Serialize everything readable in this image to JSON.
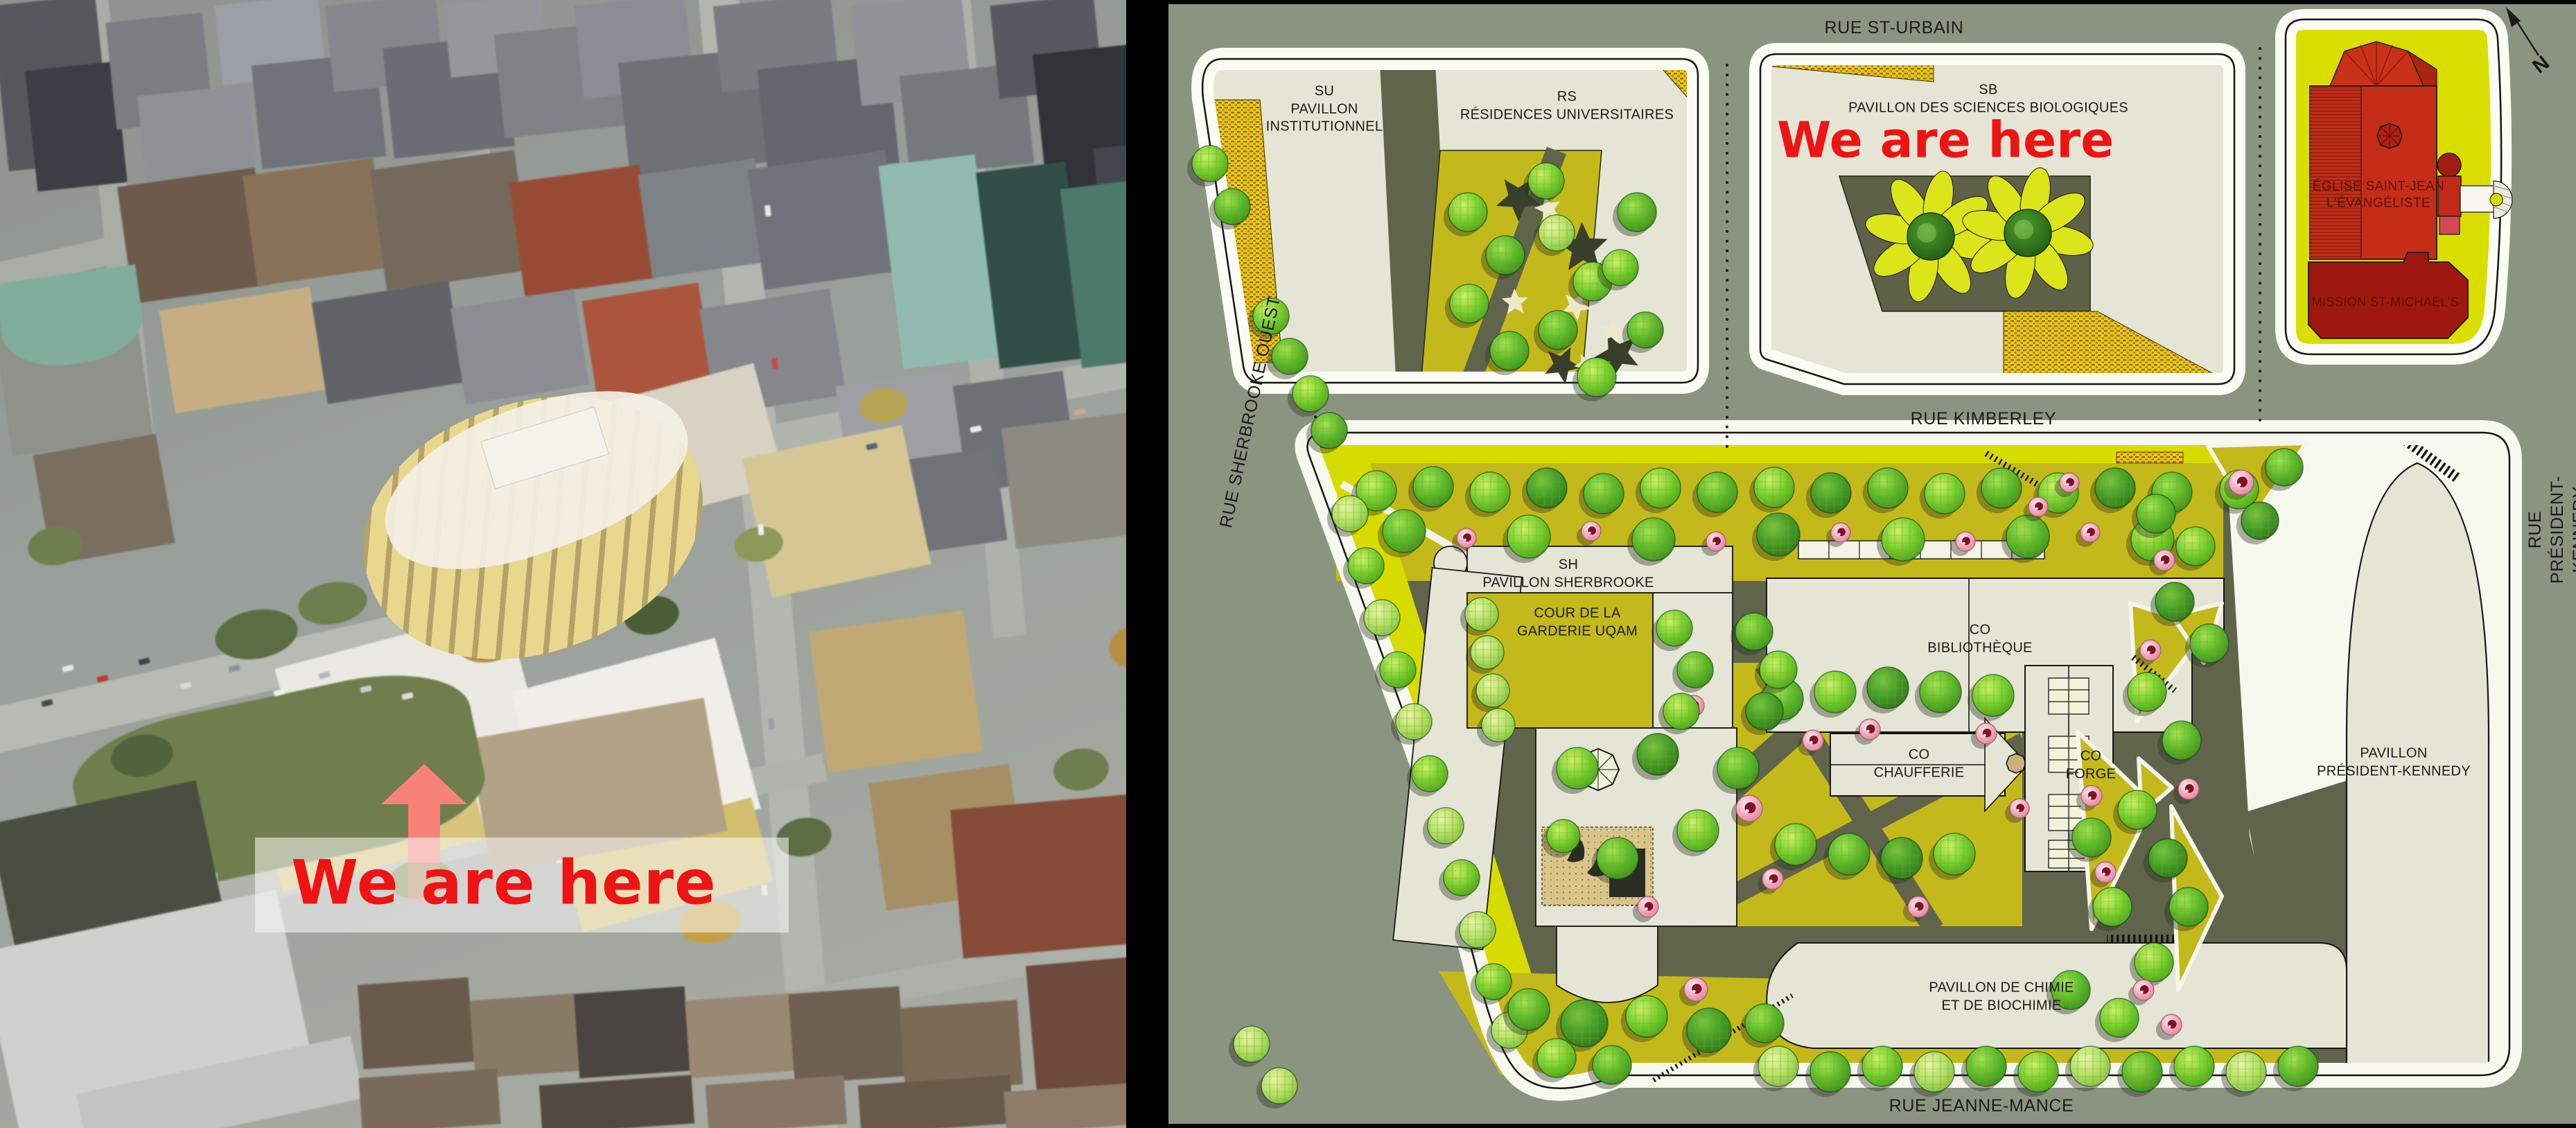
{
  "photo": {
    "we_are_here": "We are here"
  },
  "map": {
    "we_are_here": "We are here",
    "compass": "N",
    "streets": {
      "st_urbain": "RUE ST-URBAIN",
      "kimberley": "RUE KIMBERLEY",
      "sherbrooke_ouest": "RUE SHERBROOKE OUEST",
      "president_kennedy": "RUE PRÉSIDENT-KENNEDY",
      "jeanne_mance": "RUE JEANNE-MANCE"
    },
    "buildings": {
      "su": "SU\nPAVILLON\nINSTITUTIONNEL",
      "rs": "RS\nRÉSIDENCES UNIVERSITAIRES",
      "sb": "SB\nPAVILLON DES SCIENCES BIOLOGIQUES",
      "eglise": "ÉGLISE SAINT-JEAN\nL'ÉVANGÉLISTE",
      "mission": "MISSION ST-MICHAEL'S",
      "sh": "SH\nPAVILLON SHERBROOKE",
      "cour": "COUR DE LA\nGARDERIE UQAM",
      "bibliotheque": "CO\nBIBLIOTHÈQUE",
      "chaufferie": "CO\nCHAUFFERIE",
      "forge": "CO\nFORGE",
      "president_kennedy_pav": "PAVILLON\nPRÉSIDENT-KENNEDY",
      "chimie": "PAVILLON DE CHIMIE\nET DE BIOCHIMIE"
    },
    "colors": {
      "street": "#8b9481",
      "sidewalk": "#f7f8ee",
      "building": "#e4e5d4",
      "garden": "#c3b91b",
      "chartreuse": "#d8db00",
      "path_dark": "#60644b",
      "hatch_yellow": "#ecc51f",
      "tree_green": "#6cd32e",
      "flower_pink": "#f2a7bd",
      "church_red": "#c52d17",
      "mission_red": "#9e1810",
      "marker_red": "#ee1414"
    }
  }
}
